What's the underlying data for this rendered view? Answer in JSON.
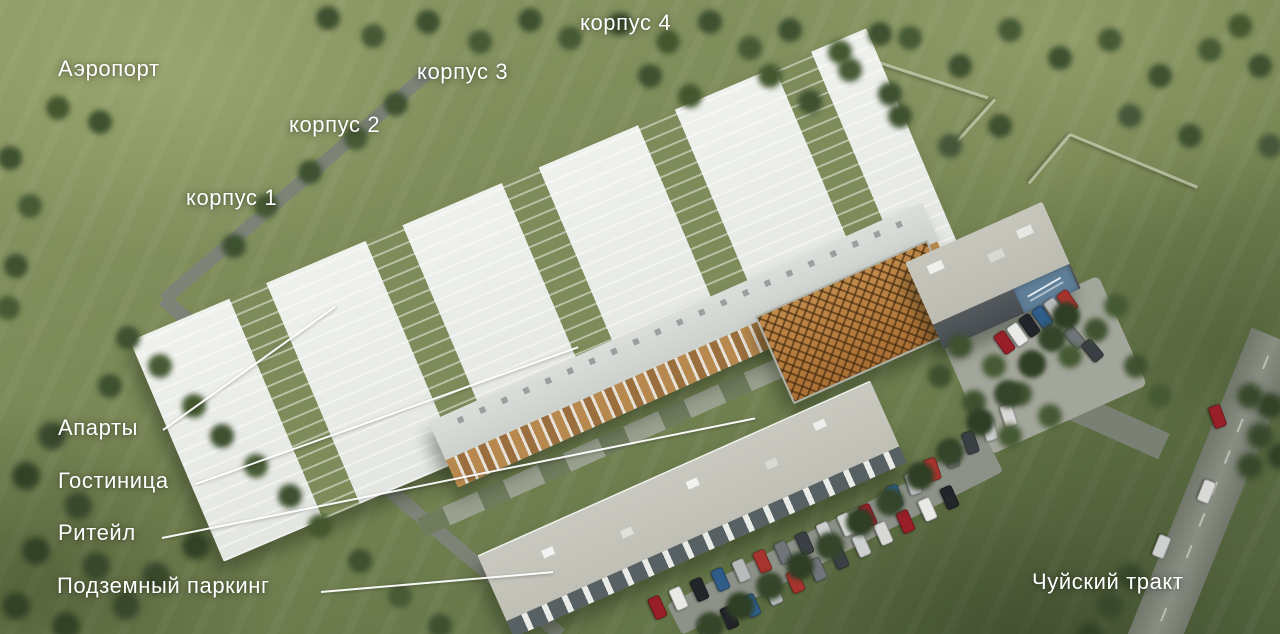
{
  "image": {
    "kind": "aerial-3d-render-of-residential-complex",
    "annotations": {
      "airport": "Аэропорт",
      "korpus_1": "корпус 1",
      "korpus_2": "корпус 2",
      "korpus_3": "корпус 3",
      "korpus_4": "корпус 4",
      "aparts": "Апарты",
      "hotel": "Гостиница",
      "retail": "Ритейл",
      "underground_parking": "Подземный паркинг",
      "highway": "Чуйский тракт"
    },
    "colors": {
      "annotation_text": "#ffffff",
      "leader_line": "#ffffff",
      "grass_light": "#8e9a66",
      "grass_dark": "#566741",
      "tree": "#3e5130",
      "road_asphalt": "#7d8377",
      "building_white": "#eff1ed",
      "roof_light": "#d8dcda",
      "gravel_roof": "#c6c6bc",
      "wood_facade": "#b8894f",
      "lattice_roof": "#b5793c",
      "store_sign_blue": "#5f7e97"
    },
    "car_colors": [
      "#e9eae8",
      "#b8bbbc",
      "#3b4044",
      "#981f27",
      "#2f5d8a",
      "#70757a",
      "#d8d9d6",
      "#22252a",
      "#a7342e",
      "#cdd0cf"
    ]
  }
}
